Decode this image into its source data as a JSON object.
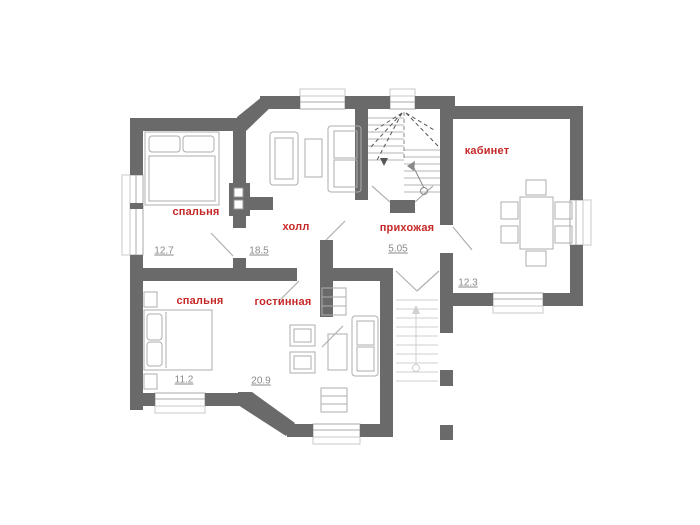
{
  "plan": {
    "title": "floor-plan",
    "wall_color": "#6a6a6a",
    "label_color": "#c62828",
    "area_color": "#8a8a8a",
    "rooms": [
      {
        "id": "bedroom-1",
        "label": "спальня",
        "area": "12.7"
      },
      {
        "id": "hall",
        "label": "холл",
        "area": "18.5"
      },
      {
        "id": "entry-hall",
        "label": "прихожая",
        "area": "5.05"
      },
      {
        "id": "study",
        "label": "кабинет",
        "area": "12.3"
      },
      {
        "id": "bedroom-2",
        "label": "спальня",
        "area": "11.2"
      },
      {
        "id": "living-room",
        "label": "гостинная",
        "area": "20.9"
      }
    ]
  }
}
